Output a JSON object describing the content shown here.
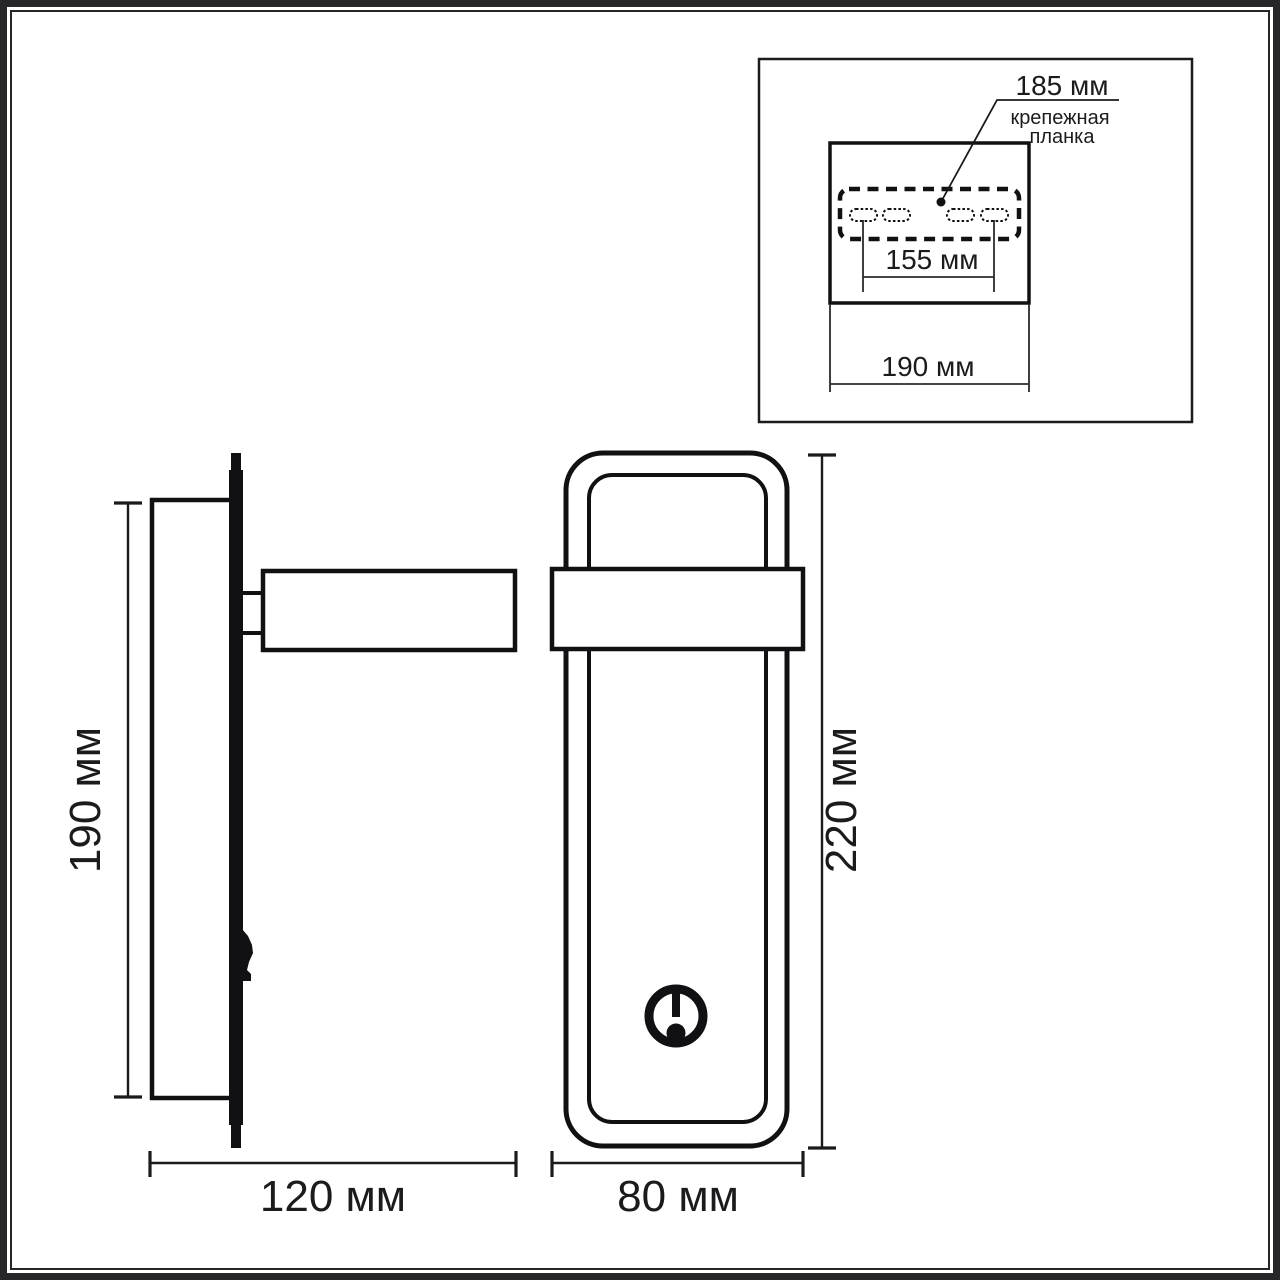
{
  "drawing": {
    "description": "wall lamp dimension drawing",
    "colors": {
      "line": "#1b1b1d",
      "background": "#ffffff"
    },
    "inset": {
      "plate_width": "185 мм",
      "caption_line1": "крепежная",
      "caption_line2": "планка",
      "slot_spacing": "155 мм",
      "overall_width": "190 мм"
    },
    "side_view": {
      "height": "190 мм",
      "depth": "120 мм"
    },
    "front_view": {
      "height": "220 мм",
      "width": "80 мм"
    }
  }
}
